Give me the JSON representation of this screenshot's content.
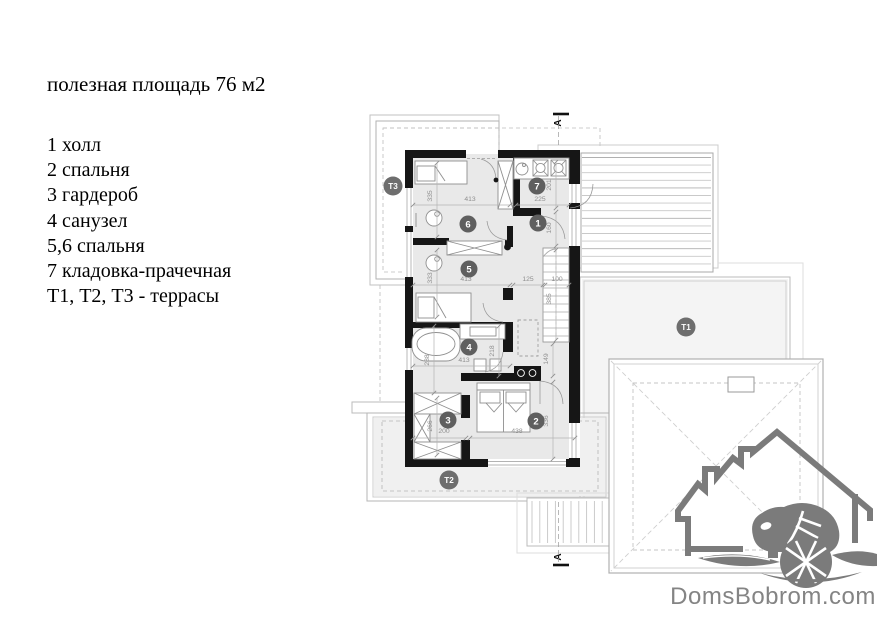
{
  "legend": {
    "title": "полезная площадь 76 м2",
    "items": [
      "1 холл",
      "2 спальня",
      "3 гардероб",
      "4 санузел",
      "5,6 спальня",
      "7 кладовка-прачечная",
      "Т1, Т2, Т3 - террасы"
    ]
  },
  "plan": {
    "room_markers": [
      {
        "label": "1",
        "x": 538,
        "y": 223
      },
      {
        "label": "2",
        "x": 536,
        "y": 421
      },
      {
        "label": "3",
        "x": 448,
        "y": 420
      },
      {
        "label": "4",
        "x": 469,
        "y": 347
      },
      {
        "label": "5",
        "x": 469,
        "y": 269
      },
      {
        "label": "6",
        "x": 468,
        "y": 224
      },
      {
        "label": "7",
        "x": 537,
        "y": 186
      }
    ],
    "terrace_markers": [
      {
        "label": "Т1",
        "x": 686,
        "y": 327
      },
      {
        "label": "Т2",
        "x": 449,
        "y": 480
      },
      {
        "label": "Т3",
        "x": 393,
        "y": 186
      }
    ],
    "dimensions": [
      {
        "text": "335",
        "x": 432,
        "y": 196,
        "vertical": true,
        "line": [
          437,
          163,
          437,
          237
        ]
      },
      {
        "text": "413",
        "x": 470,
        "y": 201,
        "vertical": false,
        "line": [
          413,
          205,
          510,
          205
        ]
      },
      {
        "text": "225",
        "x": 540,
        "y": 201,
        "vertical": false,
        "line": [
          516,
          205,
          569,
          205
        ]
      },
      {
        "text": "201",
        "x": 551,
        "y": 185,
        "vertical": true,
        "line": [
          556,
          162,
          556,
          208
        ]
      },
      {
        "text": "160",
        "x": 551,
        "y": 228,
        "vertical": true,
        "line": [
          556,
          212,
          556,
          246
        ]
      },
      {
        "text": "333",
        "x": 432,
        "y": 278,
        "vertical": true,
        "line": [
          437,
          250,
          437,
          317
        ]
      },
      {
        "text": "413",
        "x": 466,
        "y": 281,
        "vertical": false,
        "line": [
          413,
          285,
          510,
          285
        ]
      },
      {
        "text": "125",
        "x": 528,
        "y": 281,
        "vertical": false,
        "line": [
          513,
          285,
          543,
          285
        ]
      },
      {
        "text": "100",
        "x": 557,
        "y": 281,
        "vertical": false,
        "line": [
          545,
          285,
          569,
          285
        ]
      },
      {
        "text": "385",
        "x": 551,
        "y": 299,
        "vertical": true,
        "line": [
          556,
          250,
          556,
          340
        ]
      },
      {
        "text": "288",
        "x": 429,
        "y": 360,
        "vertical": true,
        "line": [
          434,
          326,
          434,
          393
        ]
      },
      {
        "text": "413",
        "x": 464,
        "y": 362,
        "vertical": false,
        "line": [
          413,
          366,
          510,
          366
        ]
      },
      {
        "text": "218",
        "x": 494,
        "y": 351,
        "vertical": true,
        "line": [
          499,
          326,
          499,
          376
        ]
      },
      {
        "text": "149",
        "x": 548,
        "y": 359,
        "vertical": true,
        "line": [
          553,
          344,
          553,
          376
        ]
      },
      {
        "text": "266",
        "x": 432,
        "y": 426,
        "vertical": true,
        "line": [
          437,
          398,
          437,
          455
        ]
      },
      {
        "text": "200",
        "x": 444,
        "y": 433,
        "vertical": false,
        "line": [
          413,
          438,
          466,
          438
        ]
      },
      {
        "text": "438",
        "x": 517,
        "y": 433,
        "vertical": false,
        "line": [
          470,
          438,
          575,
          438
        ]
      },
      {
        "text": "336",
        "x": 548,
        "y": 421,
        "vertical": true,
        "line": [
          553,
          382,
          553,
          459
        ]
      }
    ],
    "section_markers": [
      {
        "label": "А",
        "x": 561,
        "y": 123,
        "line": [
          553,
          114,
          569,
          114
        ]
      },
      {
        "label": "А",
        "x": 561,
        "y": 557,
        "line": [
          553,
          565,
          569,
          565
        ]
      }
    ]
  },
  "logo": {
    "text": "DomsBobrom.com"
  },
  "colors": {
    "wall": "#161616",
    "room_fill": "#e9e9e9",
    "marker": "#5f5f5f",
    "terrace_marker": "#6e6e6e",
    "dim": "#8f8f8f",
    "logo": "#7b7b7b"
  }
}
